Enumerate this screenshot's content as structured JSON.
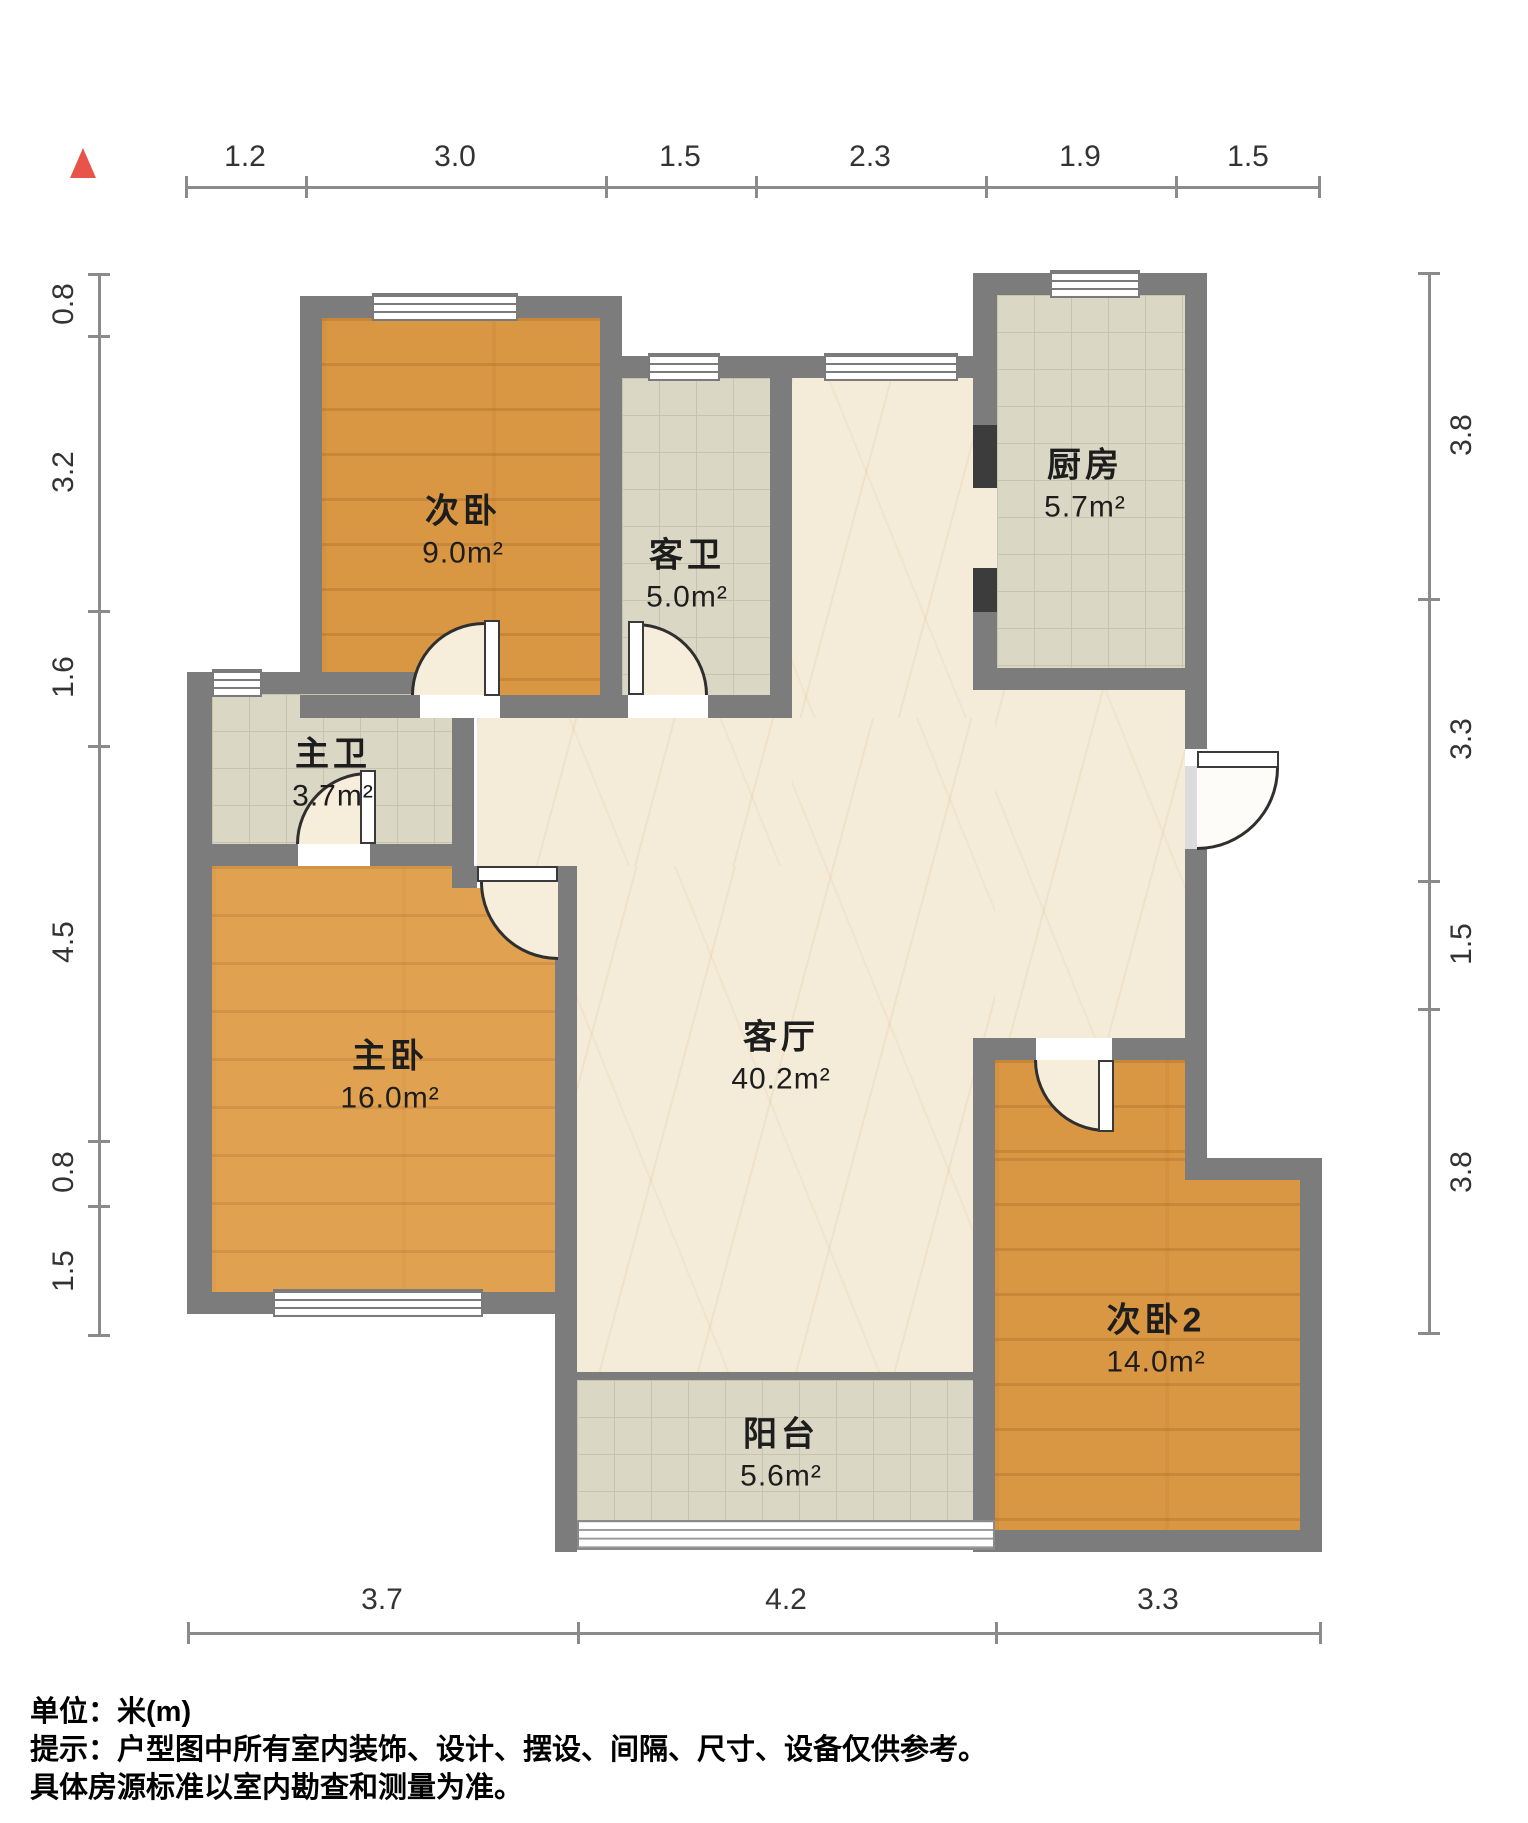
{
  "plan": {
    "title": "户型图",
    "unit": "米(m)",
    "marker_color": "#e8534a",
    "wall_color": "#7c7c7c"
  },
  "dimensions": {
    "top": [
      "1.2",
      "3.0",
      "1.5",
      "2.3",
      "1.9",
      "1.5"
    ],
    "left": [
      "0.8",
      "3.2",
      "1.6",
      "4.5",
      "0.8",
      "1.5"
    ],
    "right": [
      "3.8",
      "3.3",
      "1.5",
      "3.8"
    ],
    "bottom": [
      "3.7",
      "4.2",
      "3.3"
    ]
  },
  "rooms": {
    "cibedroom": {
      "name": "次卧",
      "area": "9.0m²"
    },
    "guest_bath": {
      "name": "客卫",
      "area": "5.0m²"
    },
    "kitchen": {
      "name": "厨房",
      "area": "5.7m²"
    },
    "master_bath": {
      "name": "主卫",
      "area": "3.7m²"
    },
    "master_bedroom": {
      "name": "主卧",
      "area": "16.0m²"
    },
    "living_room": {
      "name": "客厅",
      "area": "40.2m²"
    },
    "cibedroom2": {
      "name": "次卧2",
      "area": "14.0m²"
    },
    "balcony": {
      "name": "阳台",
      "area": "5.6m²"
    }
  },
  "footer": {
    "unit_line": "单位：米(m)",
    "tip_line1": "提示：户型图中所有室内装饰、设计、摆设、间隔、尺寸、设备仅供参考。",
    "tip_line2": "具体房源标准以室内勘查和测量为准。"
  }
}
